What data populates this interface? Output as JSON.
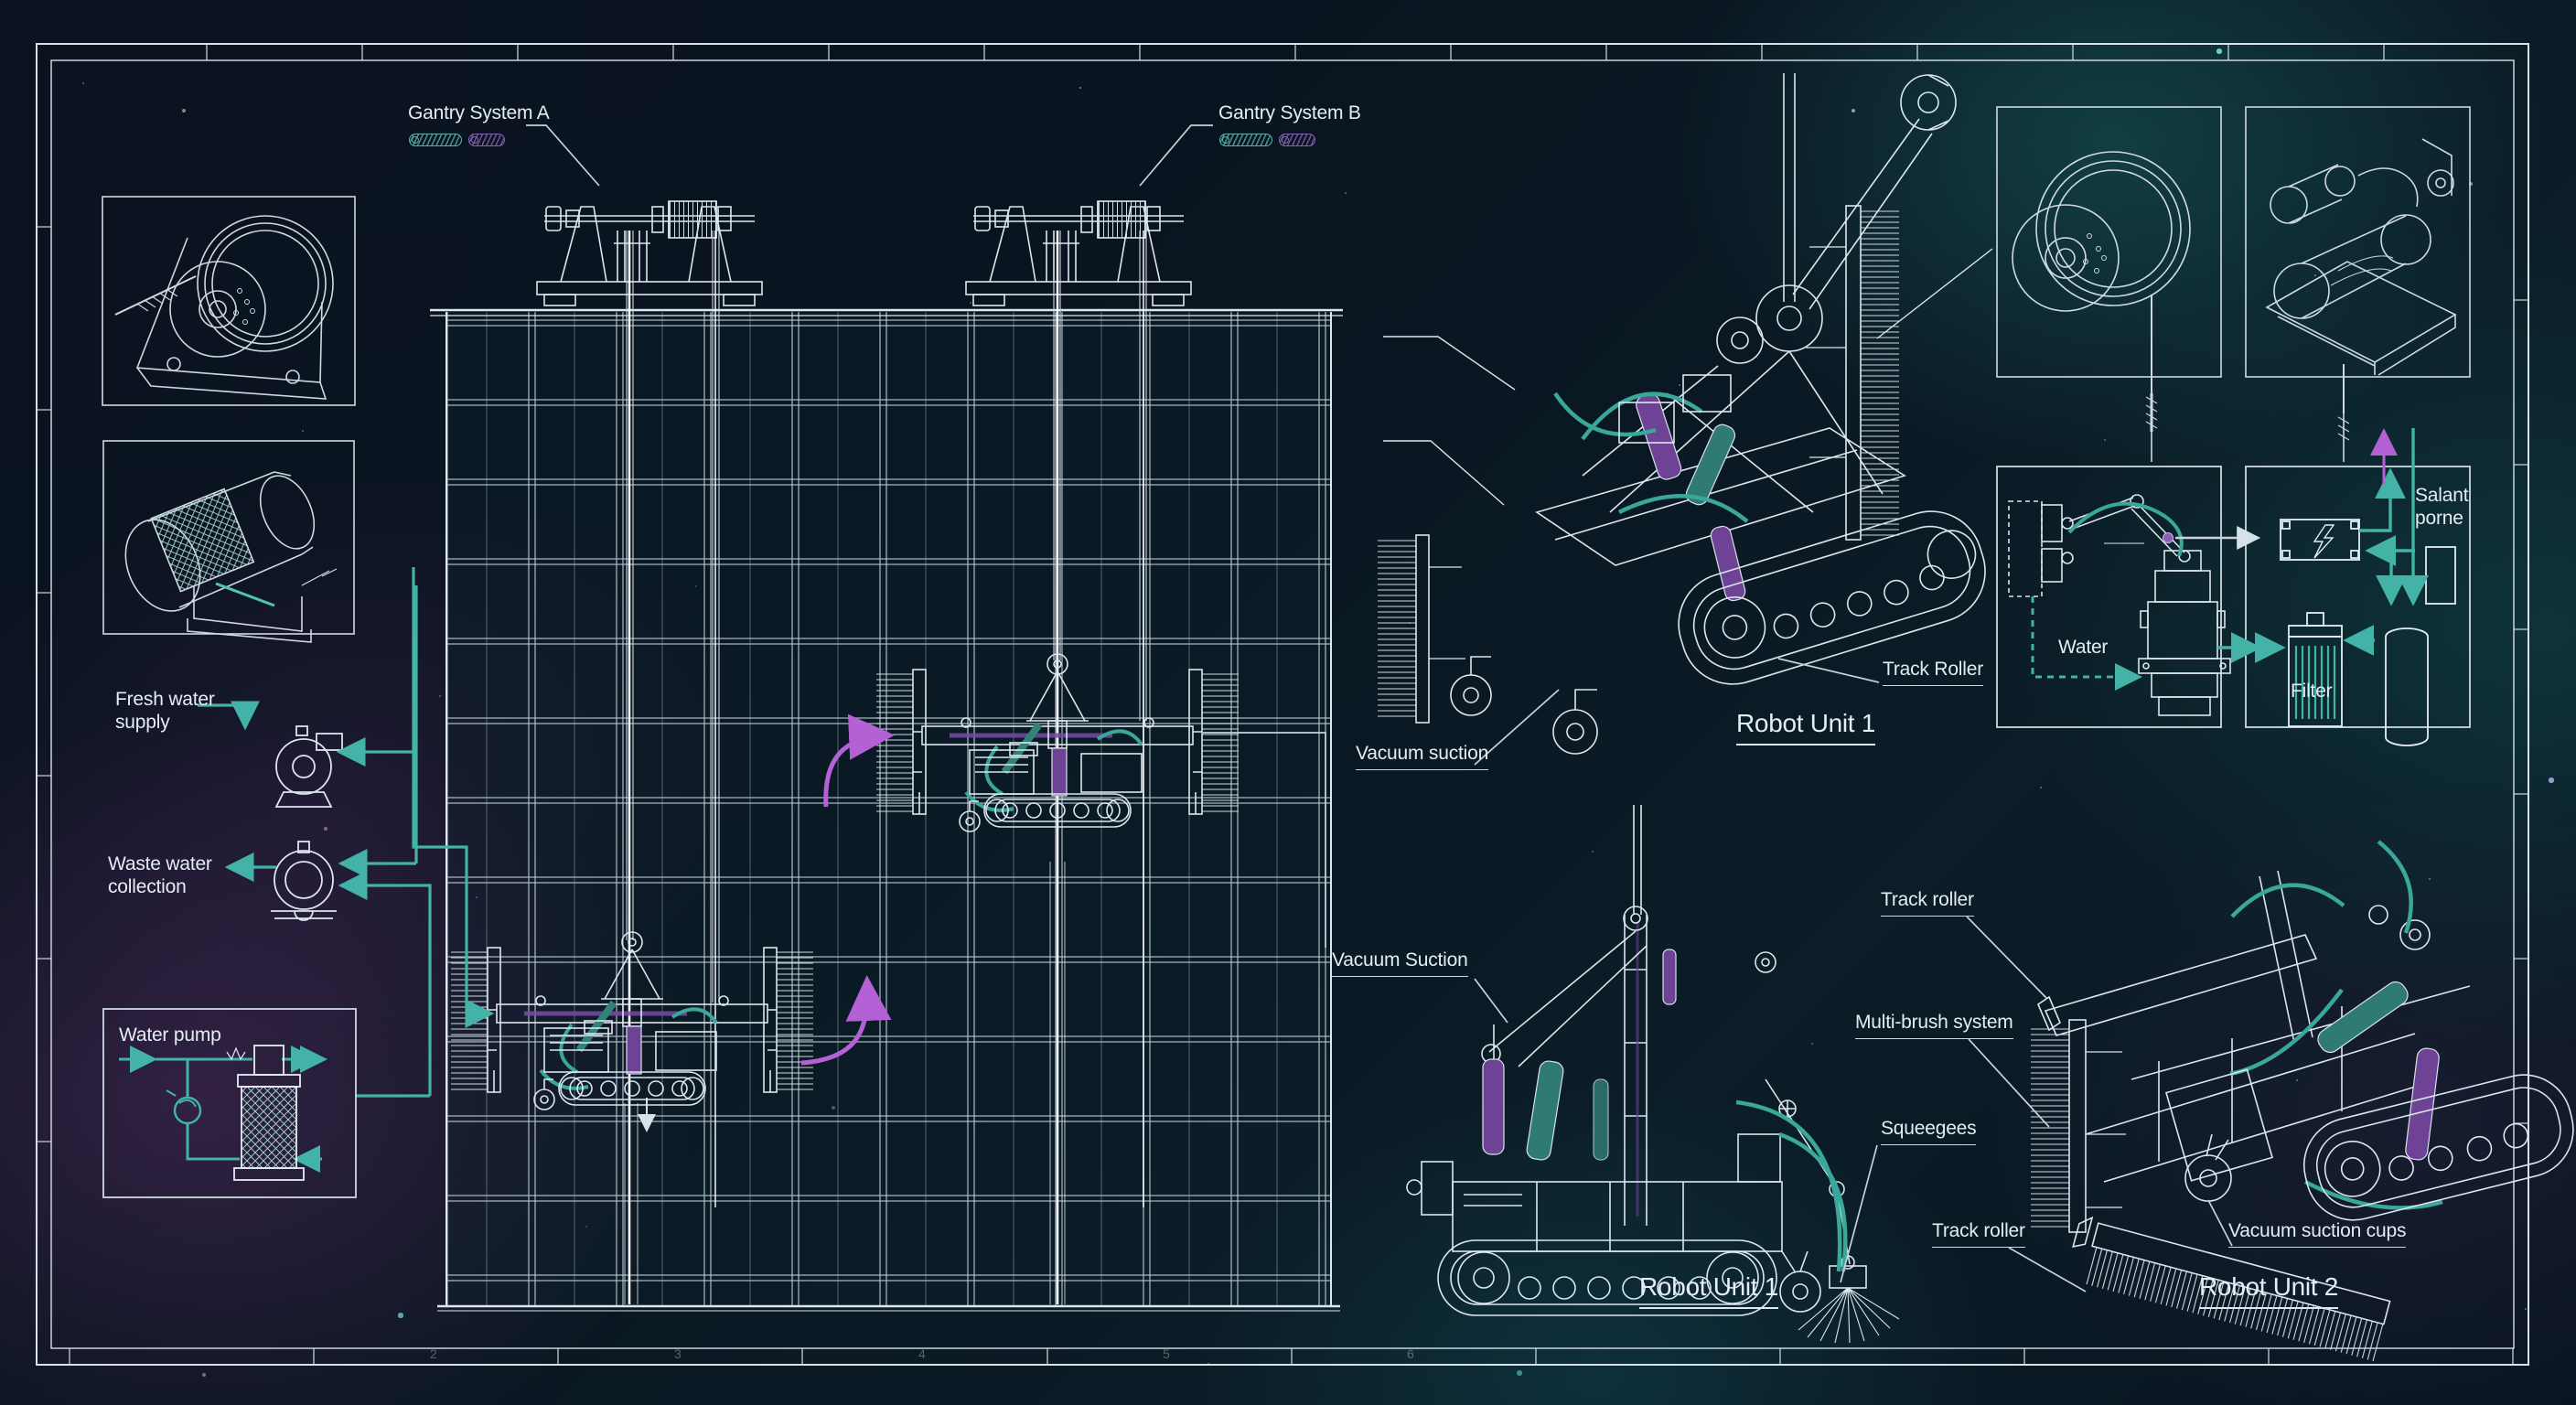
{
  "colors": {
    "accent_teal": "#43b3a7",
    "accent_purple": "#b561d6",
    "line_white": "#dce6ee",
    "cylinder_purple": "#6e4395",
    "cylinder_teal": "#2f7a72",
    "background": "#0a1420"
  },
  "gantry": {
    "a_label": "Gantry System A",
    "b_label": "Gantry System B"
  },
  "left_panel": {
    "fresh_water_line1": "Fresh water",
    "fresh_water_line2": "supply",
    "waste_water_line1": "Waste water",
    "waste_water_line2": "collection",
    "water_pump_label": "Water pump"
  },
  "robot_unit_1_iso": {
    "title": "Robot Unit 1",
    "track_roller": "Track Roller",
    "vacuum_suction": "Vacuum suction"
  },
  "robot_unit_1_side": {
    "title": "Robot Unit 1",
    "vacuum_suction": "Vacuum Suction",
    "squeegees": "Squeegees"
  },
  "robot_unit_2": {
    "title": "Robot Unit 2",
    "track_roller_top": "Track roller",
    "multi_brush": "Multi-brush system",
    "track_roller_bottom": "Track roller",
    "vacuum_cups": "Vacuum suction cups"
  },
  "flow_panel": {
    "water": "Water",
    "filter": "Filter",
    "salant_line1": "Salant",
    "salant_line2": "porne"
  },
  "frame": {
    "ruler_numbers": [
      "2",
      "3",
      "4",
      "5",
      "6"
    ]
  }
}
